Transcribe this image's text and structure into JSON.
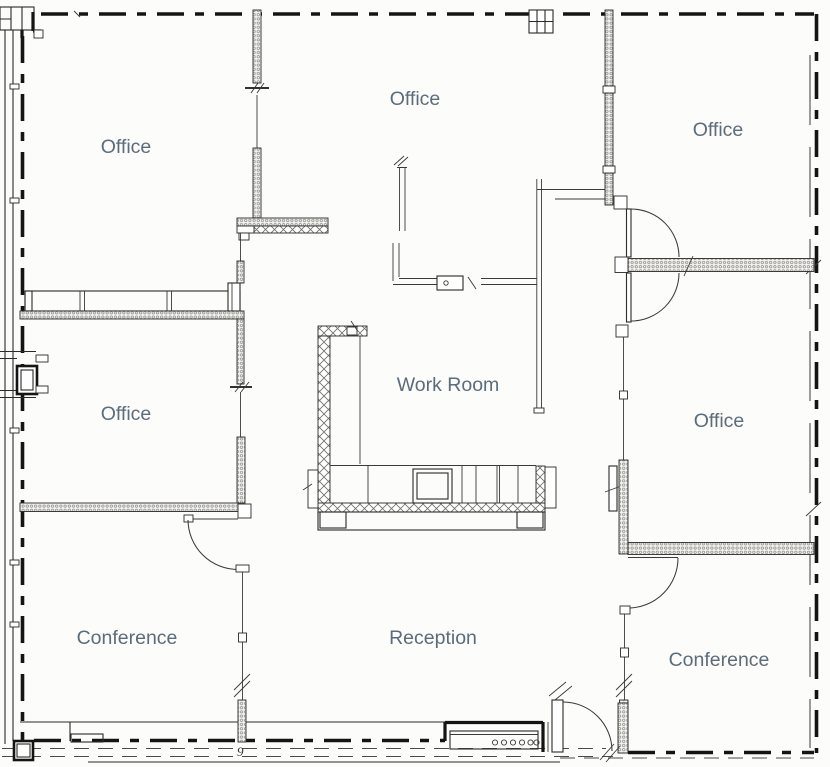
{
  "document": {
    "type": "architectural floor plan"
  },
  "colors": {
    "background": "#fcfcfa",
    "wall_line": "#2a2a28",
    "exterior_wall": "#141414",
    "room_label": "#5d6c7a"
  },
  "rooms": {
    "office_top_left": {
      "label": "Office"
    },
    "office_top_center": {
      "label": "Office"
    },
    "office_top_right": {
      "label": "Office"
    },
    "office_mid_left": {
      "label": "Office"
    },
    "work_room": {
      "label": "Work Room"
    },
    "office_mid_right": {
      "label": "Office"
    },
    "conference_left": {
      "label": "Conference"
    },
    "reception": {
      "label": "Reception"
    },
    "conference_right": {
      "label": "Conference"
    }
  },
  "annotations": {
    "keynote": "9"
  }
}
